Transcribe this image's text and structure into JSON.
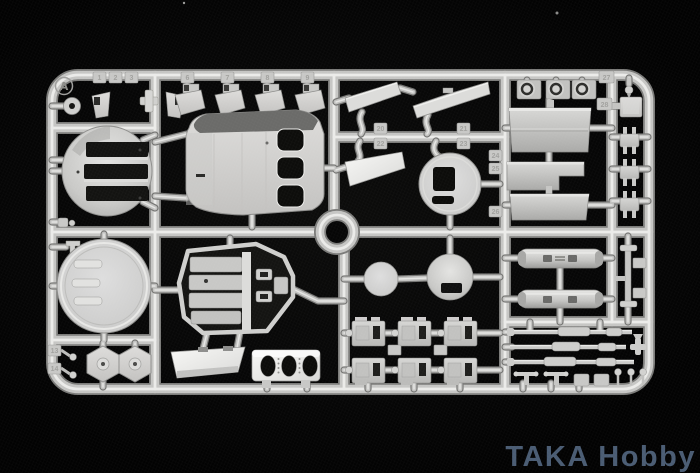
{
  "scene": {
    "description": "photograph of a light gray injection-molded model kit sprue lying on black fabric",
    "background_color": "#070707",
    "dust_speck_color": "#9a9a98"
  },
  "sprue": {
    "label": "A",
    "plastic_color": "#c6c6c4",
    "highlight_color": "#ebebe9",
    "shadow_color": "#7b7b79",
    "opening_color": "#0d0d0b"
  },
  "watermark": {
    "text": "TAKA Hobby",
    "color": "#4a5c73"
  },
  "part_tabs": [
    "1",
    "2",
    "3",
    "6",
    "7",
    "8",
    "9",
    "13",
    "14",
    "20",
    "21",
    "22",
    "23",
    "24",
    "25",
    "26",
    "27",
    "28"
  ]
}
